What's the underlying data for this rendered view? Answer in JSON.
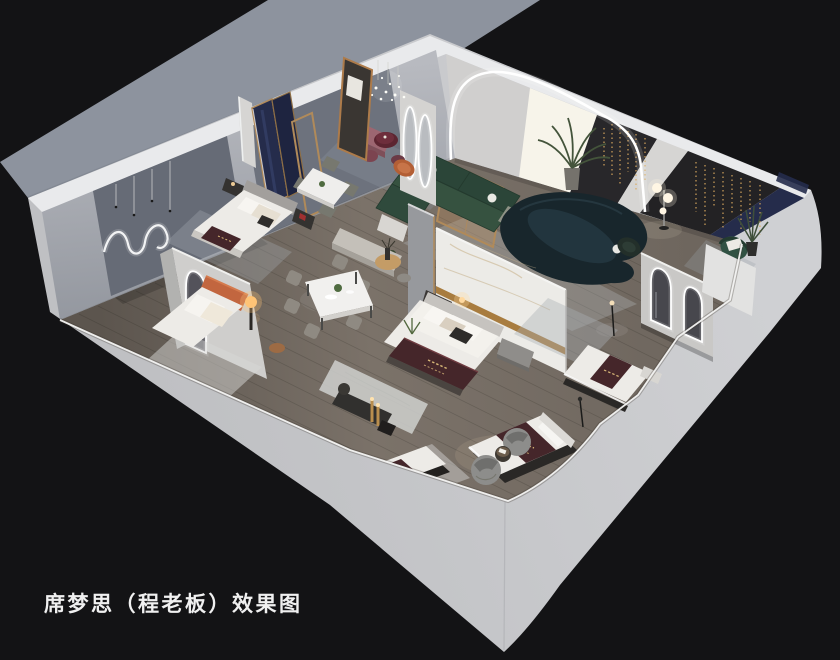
{
  "caption": {
    "text": "席梦思（程老板）效果图"
  },
  "scene": {
    "type": "isometric-cutaway-3d-render",
    "subject": "mattress showroom interior rendering",
    "areas": [
      "bedroom displays",
      "dining sets",
      "lounge with curved sofa",
      "mattress display beds",
      "arched led mirrors"
    ]
  },
  "colors": {
    "bg": "#131315",
    "platform": "#8d939e",
    "plinth": "#c6c7ca",
    "wall_top": "#e9eaec",
    "panel_dark": "#666b76",
    "panel_dark2": "#6d727d",
    "window_glow": "#f7f4ea",
    "feature_dark": "#28272a",
    "navy": "#252c4b",
    "rug": "#a9afb4",
    "rug_white": "#d8d8d6",
    "accent_blue": "#2a4cd8",
    "accent_blue_light": "#3f66f5",
    "teal_sofa": "#18262c",
    "teal_seat": "#243740",
    "green_sofa": "#2e4a3a",
    "green_chair": "#315243",
    "runner": "#45262a",
    "runner_gold": "#d8b878",
    "orange_bed": "#c2663f",
    "wood_gold": "#b08a5a",
    "marble_gold": "#a87c3f",
    "marble": "#ecebe7",
    "mattress": "#edebe7",
    "led": "#ffffff",
    "lamp_warm": "#ffc476",
    "caption_color": "#f0f0f0",
    "barrel": "#8d8d8b",
    "mauve": "#9c6671",
    "burgundy": "#5c2531"
  }
}
